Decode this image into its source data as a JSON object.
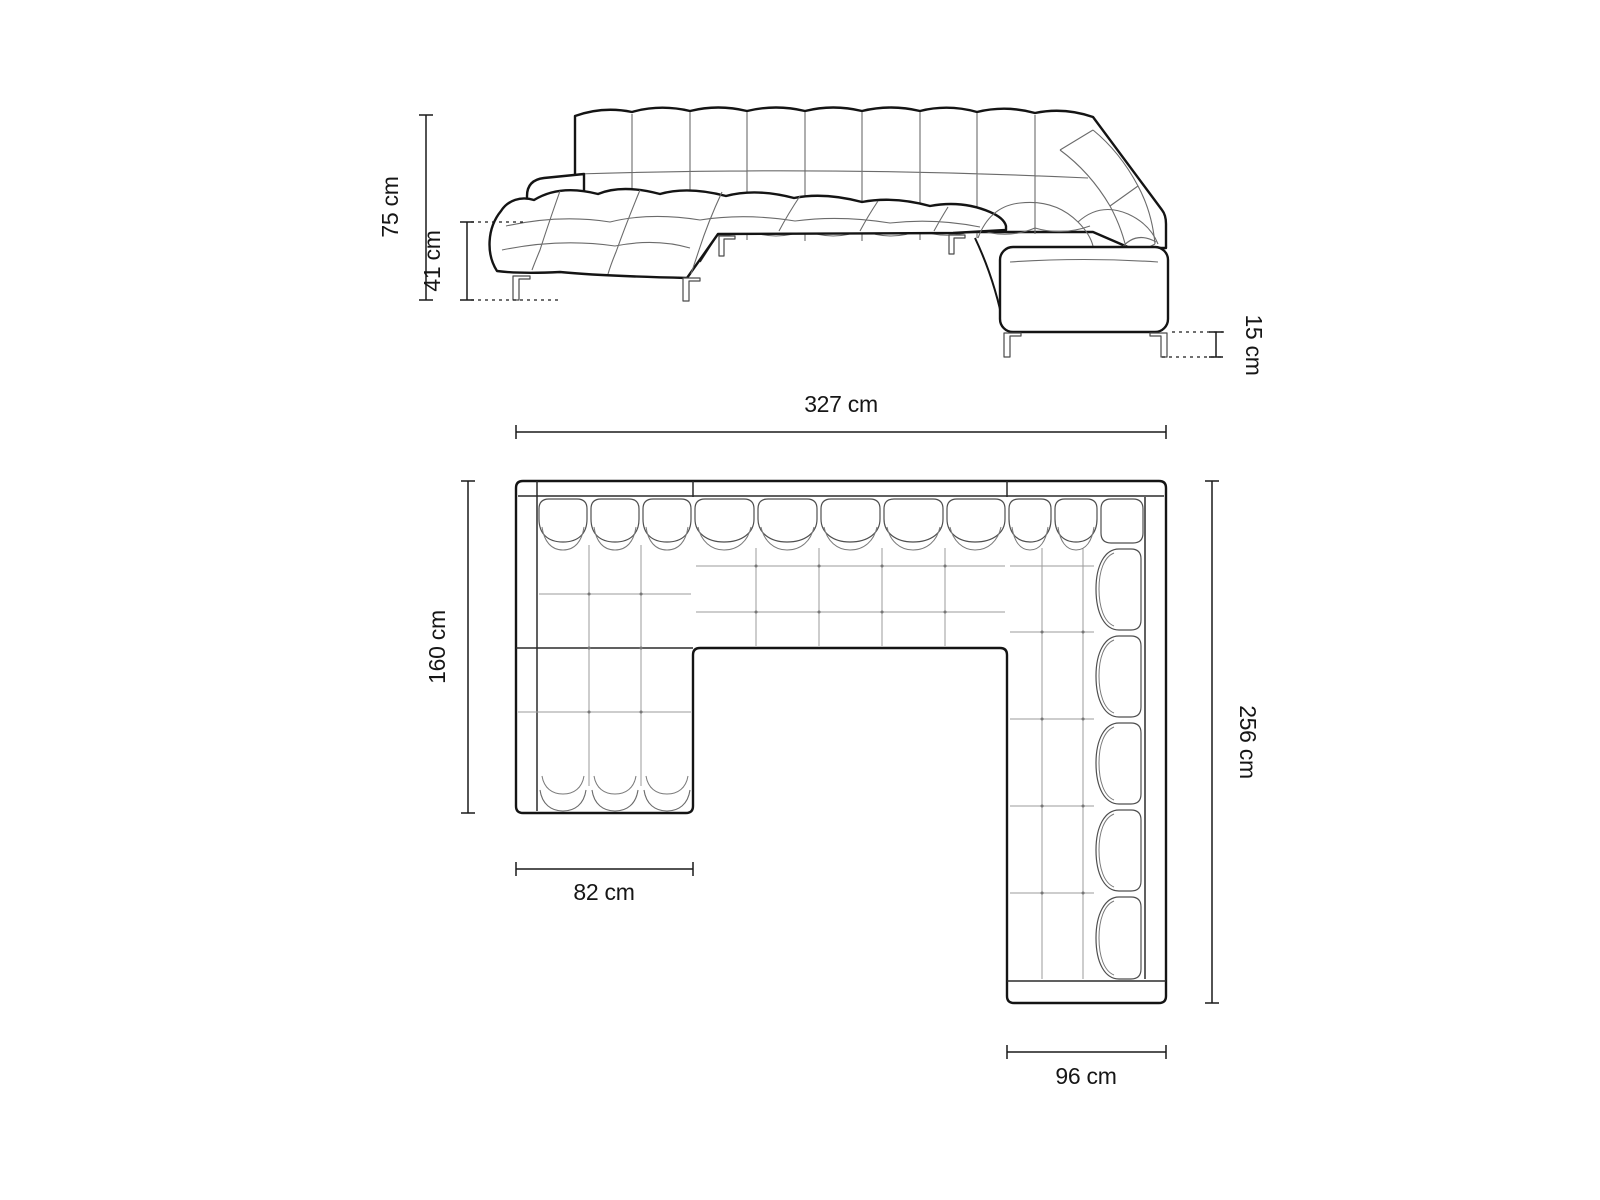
{
  "page": {
    "background": "#ffffff",
    "line_color": "#141414",
    "dimension_color": "#1a1a1a"
  },
  "views": {
    "elevation": {
      "name": "perspective-front-view"
    },
    "plan": {
      "name": "top-plan-view"
    }
  },
  "dims": {
    "height_total": {
      "label": "75 cm"
    },
    "seat_height": {
      "label": "41 cm"
    },
    "leg_height": {
      "label": "15 cm"
    },
    "width_total": {
      "label": "327 cm"
    },
    "chaise_depth": {
      "label": "160 cm"
    },
    "depth_total": {
      "label": "256 cm"
    },
    "chaise_width": {
      "label": "82 cm"
    },
    "return_width": {
      "label": "96 cm"
    }
  }
}
